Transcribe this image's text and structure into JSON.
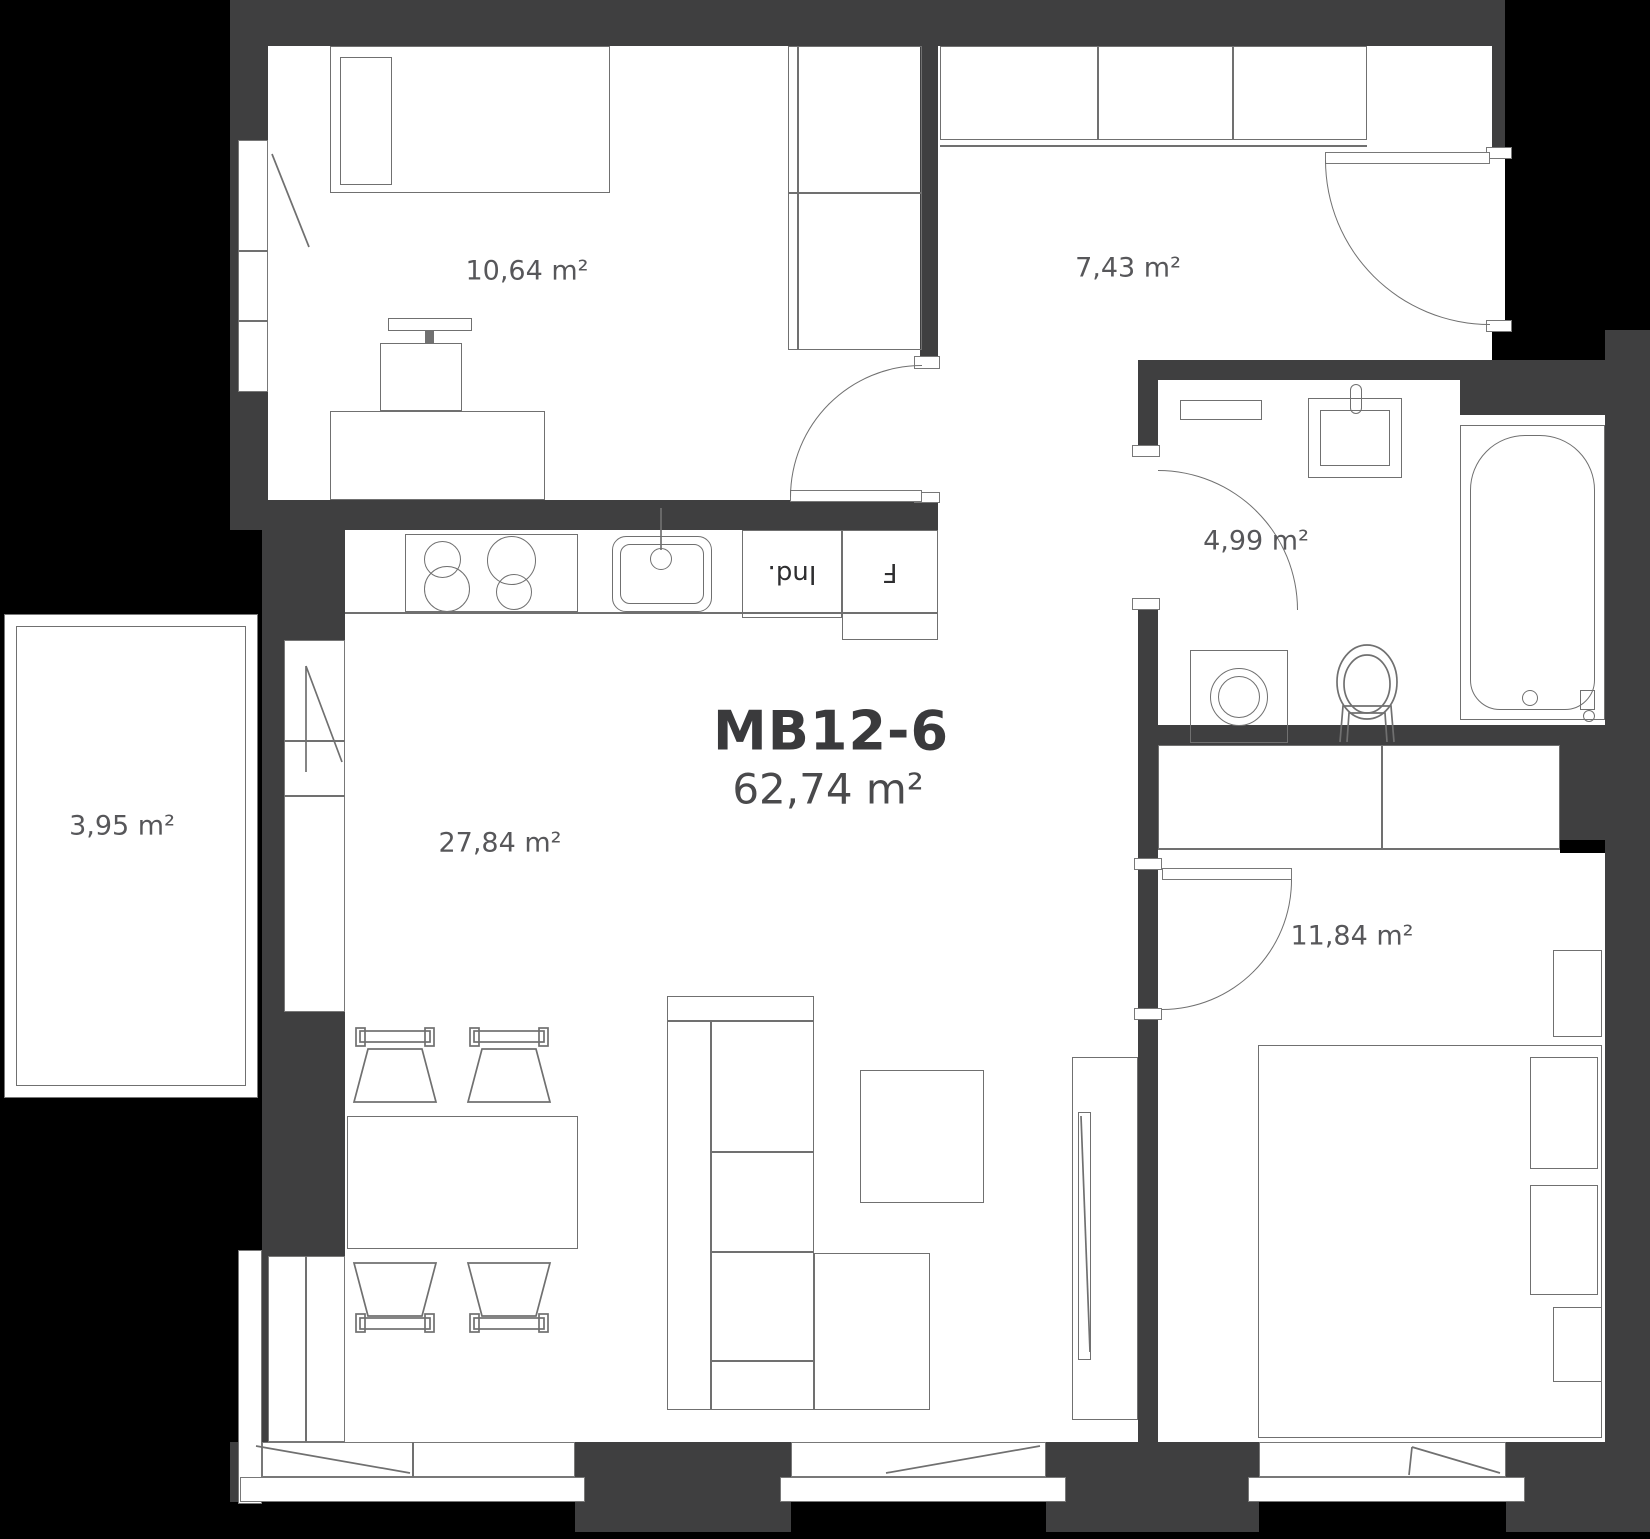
{
  "plan": {
    "unit_id": "MB12-6",
    "total_area": "62,74 m²",
    "rooms": [
      {
        "key": "room-top-left",
        "area": "10,64 m²"
      },
      {
        "key": "hallway",
        "area": "7,43 m²"
      },
      {
        "key": "bathroom",
        "area": "4,99 m²"
      },
      {
        "key": "living-kitchen",
        "area": "27,84 m²"
      },
      {
        "key": "bedroom",
        "area": "11,84 m²"
      },
      {
        "key": "balcony",
        "area": "3,95 m²"
      }
    ],
    "kitchen": {
      "induction_label": "Ind.",
      "fridge_label": "F"
    },
    "colors": {
      "wall": "#3f3f40",
      "outside": "#000000",
      "floor": "#ffffff",
      "furniture_line": "#707070",
      "label_text": "#57575a",
      "title_text": "#3a3a3c"
    }
  }
}
